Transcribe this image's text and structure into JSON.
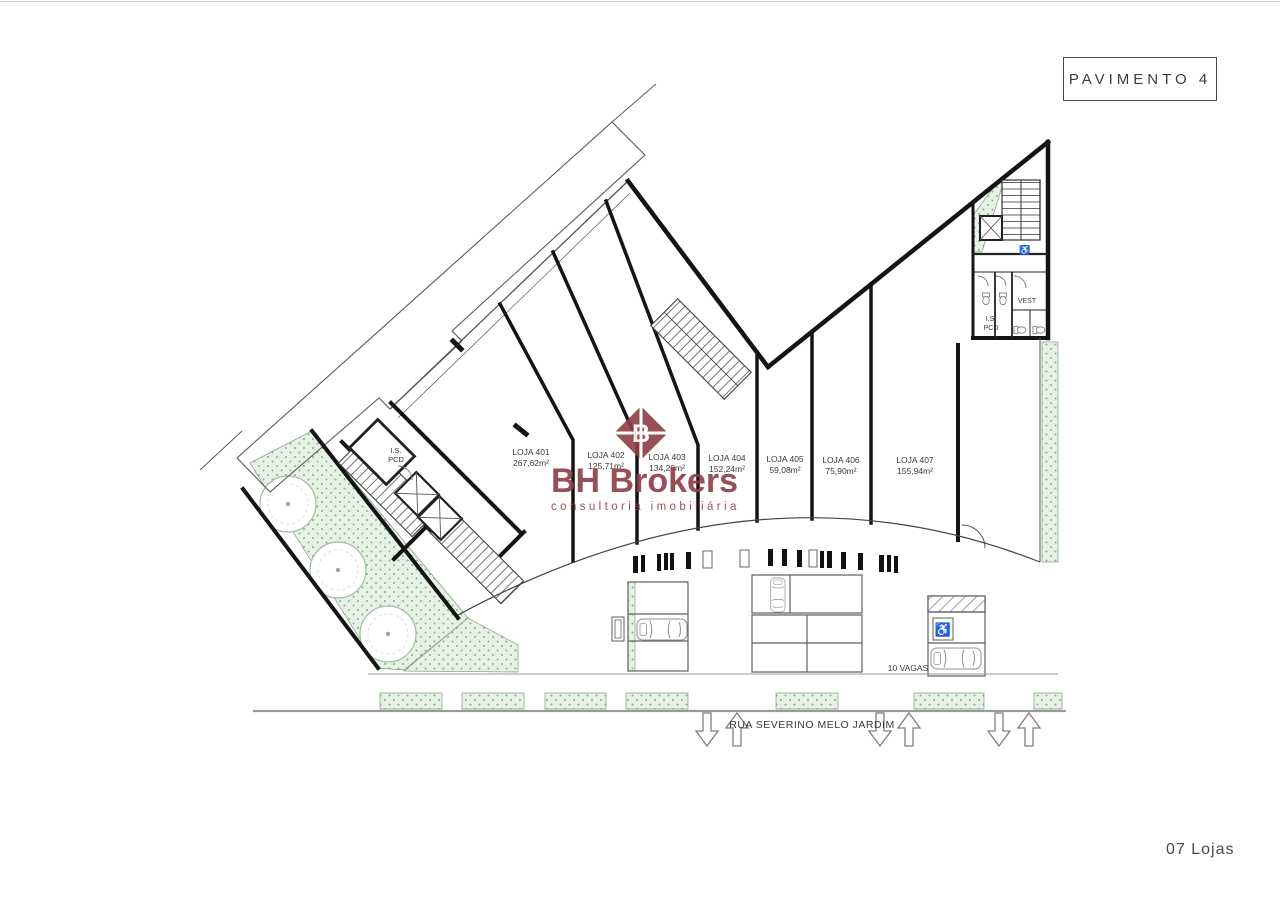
{
  "title_box": {
    "label": "PAVIMENTO 4"
  },
  "footer": {
    "label": "07 Lojas"
  },
  "watermark": {
    "brand": "BH Brokers",
    "tagline": "consultoria imobiliária",
    "logo_letter": "B",
    "color": "#8d3e45"
  },
  "plan": {
    "lojas": [
      {
        "name": "LOJA 401",
        "area": "267,62m²"
      },
      {
        "name": "LOJA 402",
        "area": "125,71m²"
      },
      {
        "name": "LOJA 403",
        "area": "134,20m²"
      },
      {
        "name": "LOJA 404",
        "area": "152,24m²"
      },
      {
        "name": "LOJA 405",
        "area": "59,08m²"
      },
      {
        "name": "LOJA 406",
        "area": "75,90m²"
      },
      {
        "name": "LOJA 407",
        "area": "155,94m²"
      }
    ],
    "labels": {
      "vagas": "10 VAGAS",
      "street": "RUA SEVERINO MELO JARDIM",
      "vest": "VEST",
      "is": "I.S.",
      "pcd": "PCD",
      "wheelchair_icon": "♿"
    }
  },
  "colors": {
    "green": "#e7f2e7",
    "green_dot": "#86ae86",
    "line": "#1c1c1c"
  }
}
